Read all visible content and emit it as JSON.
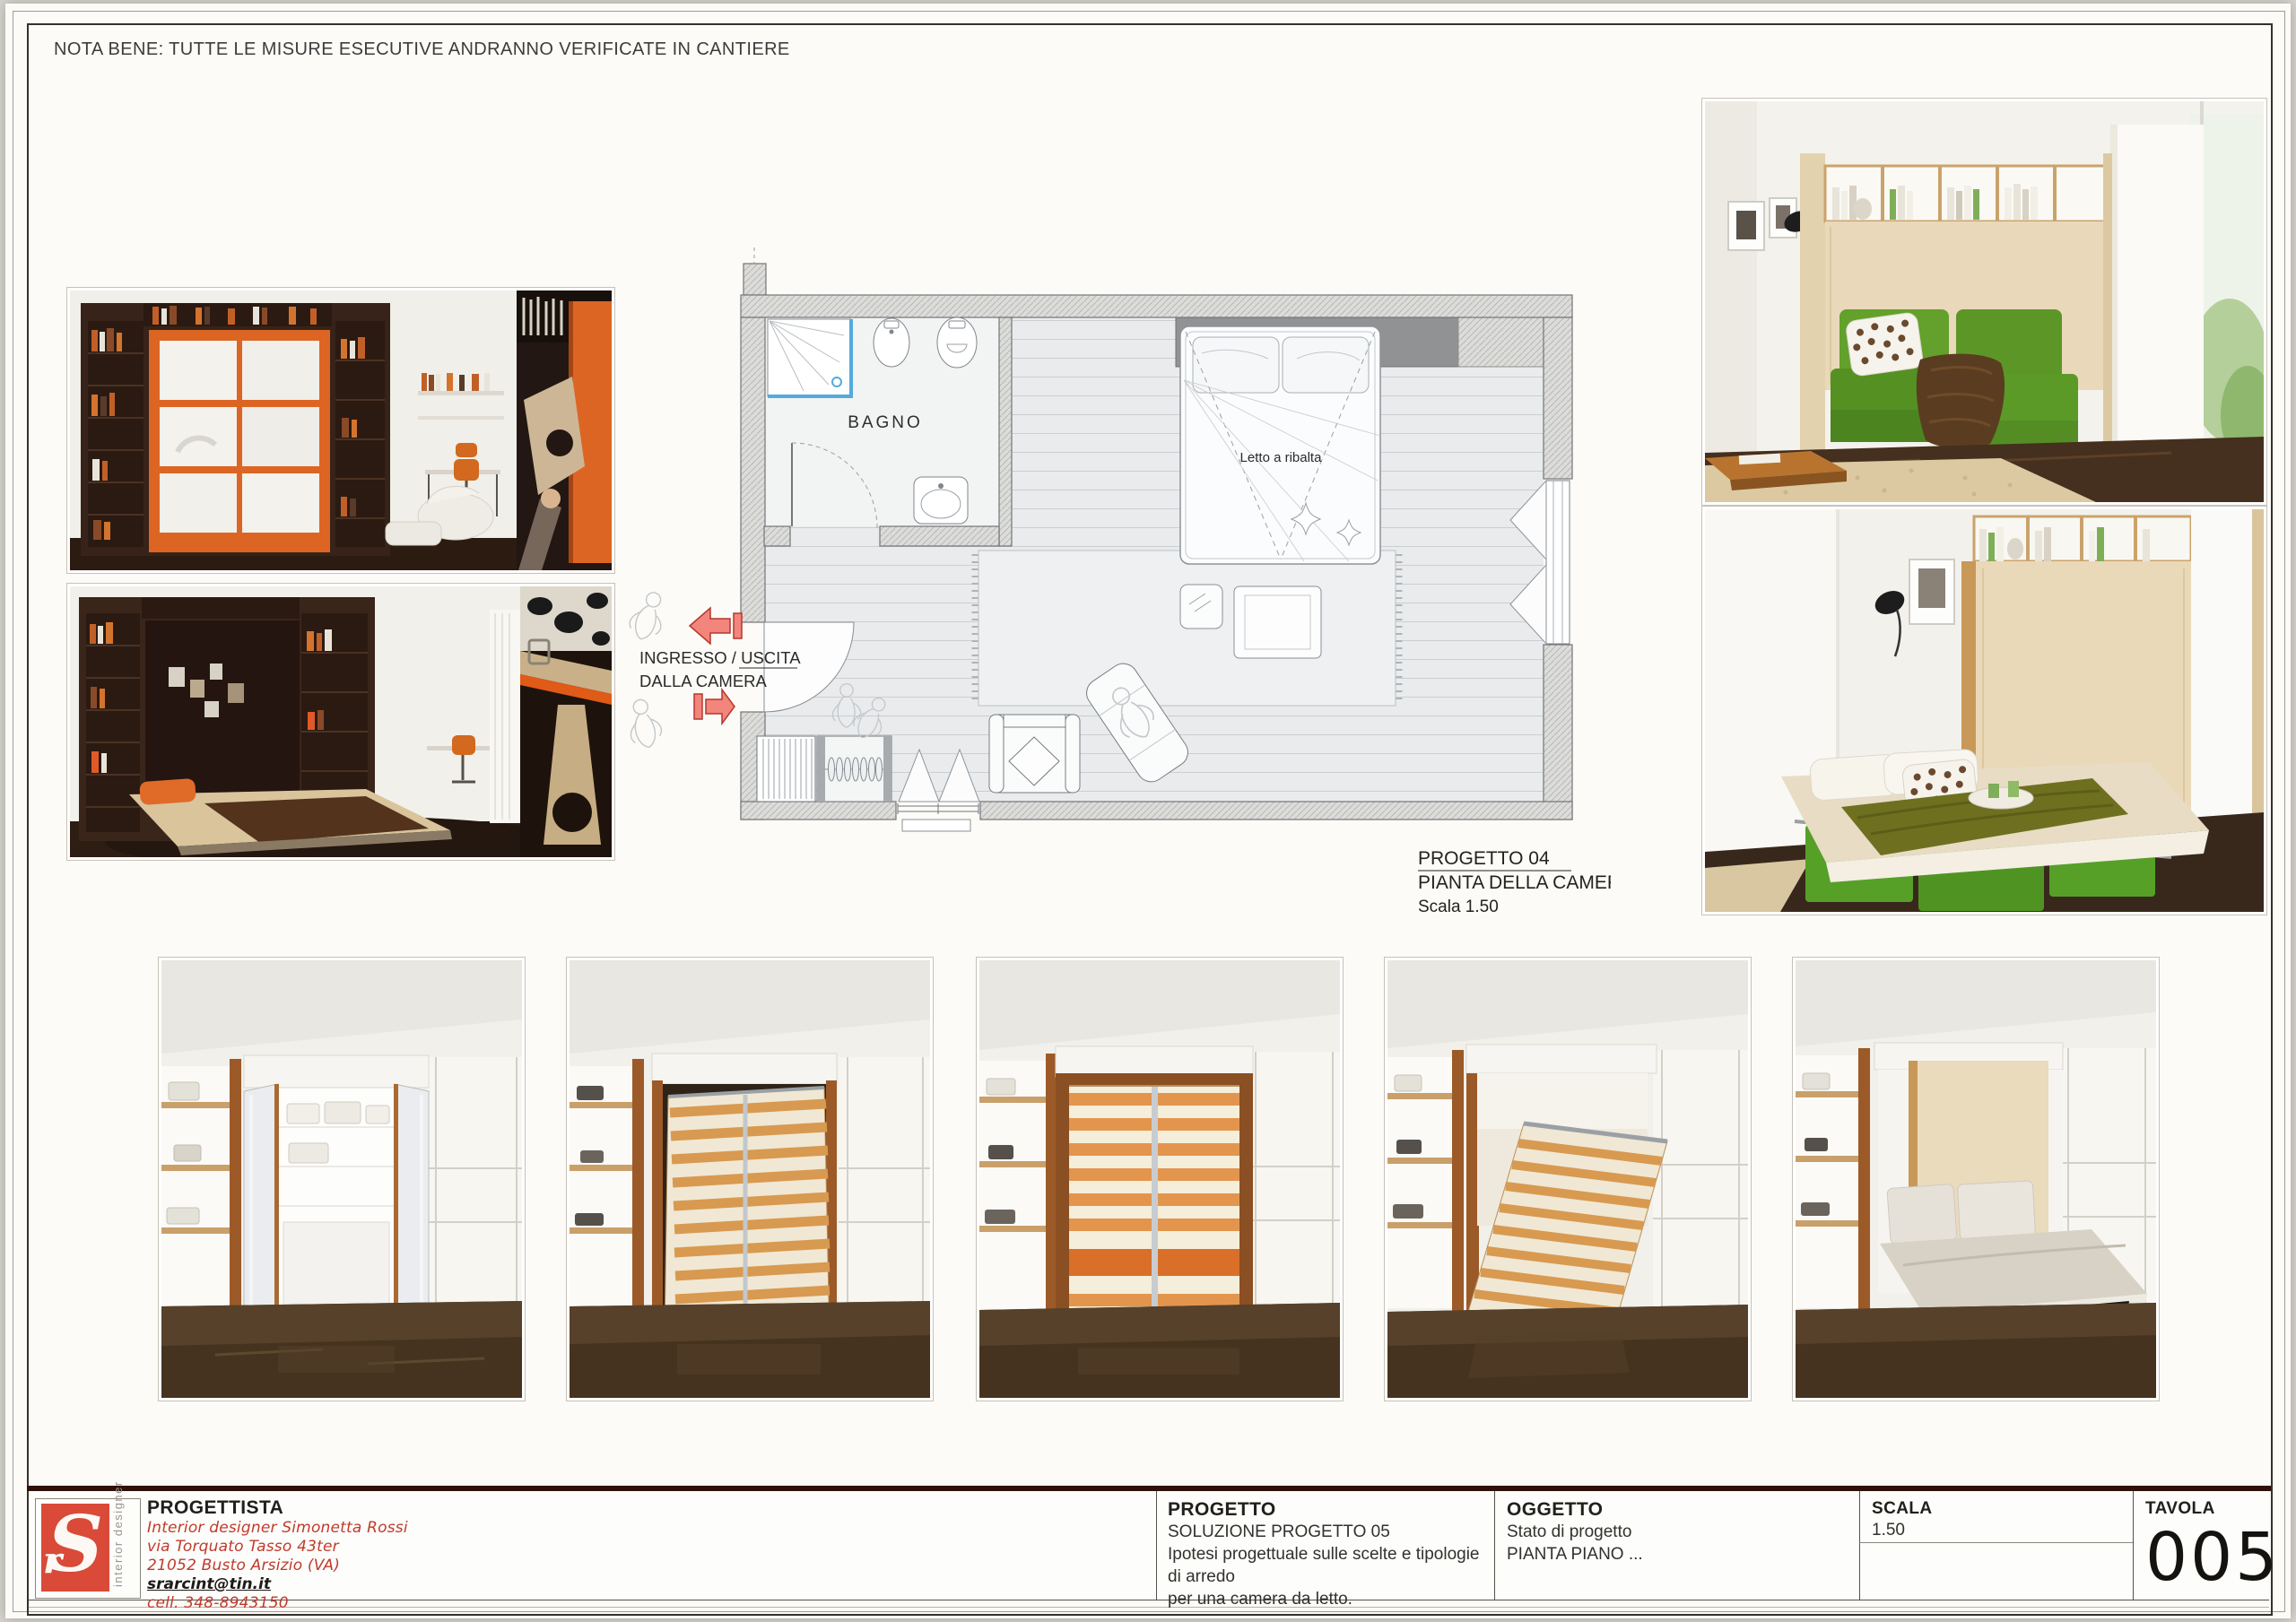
{
  "sheet": {
    "note": "NOTA BENE: TUTTE LE MISURE ESECUTIVE ANDRANNO VERIFICATE IN CANTIERE"
  },
  "plan": {
    "bagno_label": "BAGNO",
    "bed_label": "Letto a ribalta",
    "entry_line1": "INGRESSO / USCITA",
    "entry_line2": "DALLA CAMERA",
    "caption_line1": "PROGETTO 04",
    "caption_line2": "PIANTA DELLA CAMERA",
    "caption_line3": "Scala 1.50"
  },
  "title_block": {
    "progettista": {
      "label": "PROGETTISTA",
      "line1": "Interior designer Simonetta Rossi",
      "line2": "via Torquato Tasso 43ter",
      "line3": "21052 Busto Arsizio (VA)",
      "email": "srarcint@tin.it",
      "phone": "cell. 348-8943150"
    },
    "progetto": {
      "label": "PROGETTO",
      "line1": "SOLUZIONE PROGETTO 05",
      "line2": "Ipotesi progettuale sulle scelte e tipologie di arredo",
      "line3": "per una camera da letto."
    },
    "oggetto": {
      "label": "OGGETTO",
      "line1": "Stato di progetto",
      "line2": "PIANTA PIANO ..."
    },
    "scala": {
      "label": "SCALA",
      "value": "1.50"
    },
    "tavola": {
      "label": "TAVOLA",
      "value": "005"
    },
    "logo": {
      "monogram": "S",
      "tagline": "interior designer"
    }
  },
  "colors": {
    "logo_red": "#d94a38",
    "annotation_red": "#c03a2b",
    "arrow_fill": "#f2857c",
    "arrow_stroke": "#b5372e",
    "wall_gray": "#dbdbd9",
    "wardrobe_gray": "#909294"
  }
}
